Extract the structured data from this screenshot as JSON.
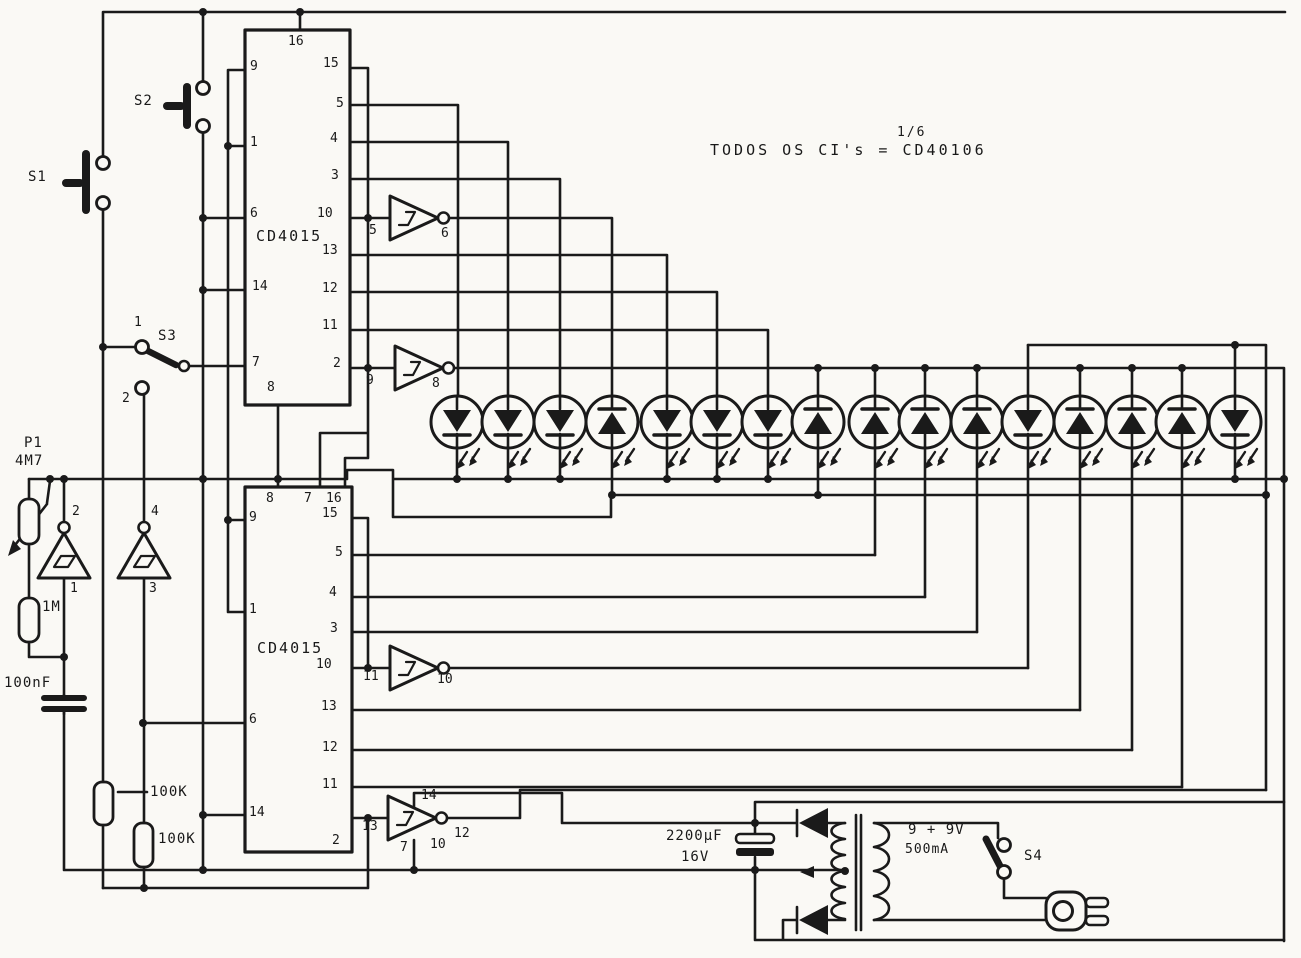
{
  "note": {
    "fraction": "1/6",
    "text": "TODOS OS CI's = CD40106"
  },
  "switches": {
    "s1": "S1",
    "s2": "S2",
    "s3": "S3",
    "s4": "S4",
    "s3_contact_top": "1",
    "s3_contact_bottom": "2"
  },
  "pot": {
    "ref": "P1",
    "value": "4M7"
  },
  "resistors": {
    "r_1m": "1M",
    "r_100k_a": "100K",
    "r_100k_b": "100K"
  },
  "capacitors": {
    "c_100nf": "100nF",
    "c_2200uf": "2200µF",
    "c_2200uf_voltage": "16V"
  },
  "transformer": {
    "secondary": "9 + 9V",
    "current": "500mA"
  },
  "ic1": {
    "name": "CD4015",
    "pin_top": "16",
    "pin_bottom": "8",
    "pins_left": [
      "9",
      "1",
      "6",
      "14",
      "7"
    ],
    "pins_right": [
      "15",
      "5",
      "4",
      "3",
      "10",
      "13",
      "12",
      "11",
      "2"
    ]
  },
  "ic2": {
    "name": "CD4015",
    "pins_top": [
      "8",
      "7",
      "16"
    ],
    "pins_left": [
      "9",
      "1",
      "6",
      "14"
    ],
    "pins_right": [
      "15",
      "5",
      "4",
      "3",
      "10",
      "13",
      "12",
      "11",
      "2"
    ]
  },
  "gates": {
    "g1": {
      "input": "5",
      "output": "6"
    },
    "g2": {
      "input": "9",
      "output": "8"
    },
    "g3": {
      "input": "1",
      "output": "2"
    },
    "g4": {
      "input": "3",
      "output": "4"
    },
    "g5": {
      "input": "11",
      "output": "10"
    },
    "g6": {
      "input": "13",
      "output": "10",
      "vdd": "14",
      "gnd": "7",
      "node": "12"
    }
  }
}
